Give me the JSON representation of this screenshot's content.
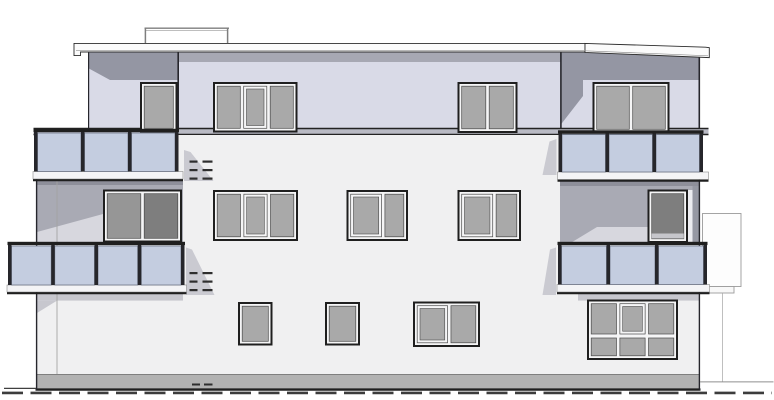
{
  "canvas": {
    "width": 774,
    "height": 400
  },
  "palette": {
    "background": "#ffffff",
    "line_dark": "#1f1f1f",
    "penthouse_wall": "#d9dae7",
    "penthouse_shadow_dark": "#9496a3",
    "penthouse_shadow_band": "#a7a8b3",
    "fascia_white": "#fbfbfb",
    "fascia_edge": "#2c2c2c",
    "terrace_band": "#b9bac4",
    "main_wall": "#f0f0f1",
    "recess_shadow": "#a9aab4",
    "recess_top_shadow": "#8e8f9a",
    "recess_light": "#d7d7de",
    "recess_white_strip": "#ececf0",
    "recess_corner": "#9698a3",
    "window_frame_white": "#f5f5f6",
    "window_glass": "#a9a9a9",
    "door_glass_dark": "#7e7e7e",
    "door_glass_mid": "#969696",
    "door_sill_light": "#c6c6cb",
    "balcony_glass": "#c4cde0",
    "balcony_frame": "#26262b",
    "slab_white": "#f4f4f6",
    "plinth_gray": "#b2b2b2",
    "soft_shadow": "#c7c7ce",
    "side_wedge": "#cacad1",
    "faint_line": "#9b9b9b",
    "rail_gray": "#808080",
    "vent_dark": "#2e2e2e",
    "ground_dash": "#3c3c3c"
  },
  "elements": {
    "windows": [
      {
        "id": "window-top-left-single",
        "x": 140,
        "y": 82,
        "w": 37.5,
        "h": 50.5,
        "panes": 1,
        "casement": null
      },
      {
        "id": "window-top-left-triple",
        "x": 213,
        "y": 82,
        "w": 84.5,
        "h": 50.5,
        "panes": 3,
        "casement": 1
      },
      {
        "id": "window-top-mid-double",
        "x": 457.5,
        "y": 82,
        "w": 60,
        "h": 51,
        "panes": 2,
        "casement": null
      },
      {
        "id": "window-top-right-double",
        "x": 592.5,
        "y": 82,
        "w": 77,
        "h": 51.5,
        "panes": 2,
        "casement": null
      },
      {
        "id": "door-mid-left-balcony",
        "x": 103,
        "y": 189.5,
        "w": 79,
        "h": 53,
        "panes": 2,
        "glass": "dark",
        "casement": null
      },
      {
        "id": "window-mid-triple",
        "x": 213,
        "y": 190,
        "w": 85,
        "h": 51,
        "panes": 3,
        "casement": 1
      },
      {
        "id": "window-mid-double-a",
        "x": 346.5,
        "y": 190,
        "w": 61.5,
        "h": 51,
        "panes": 2,
        "casement": 0,
        "split": [
          0.62,
          0.38
        ]
      },
      {
        "id": "window-mid-double-b",
        "x": 457.5,
        "y": 190,
        "w": 63.5,
        "h": 51,
        "panes": 2,
        "casement": 0,
        "split": [
          0.6,
          0.4
        ]
      },
      {
        "id": "door-mid-right-balcony",
        "x": 647.5,
        "y": 189.5,
        "w": 40.5,
        "h": 53.5,
        "panes": 1,
        "glass": "dark",
        "casement": null,
        "sill": true
      },
      {
        "id": "window-ground-small-1",
        "x": 238,
        "y": 302,
        "w": 34.5,
        "h": 43.5,
        "panes": 1,
        "casement": null
      },
      {
        "id": "window-ground-small-2",
        "x": 325,
        "y": 302,
        "w": 35,
        "h": 43.5,
        "panes": 1,
        "casement": null
      },
      {
        "id": "window-ground-double",
        "x": 413,
        "y": 301.5,
        "w": 67,
        "h": 45.5,
        "panes": 2,
        "casement": 0,
        "split": [
          0.55,
          0.45
        ]
      },
      {
        "id": "window-ground-large",
        "x": 587,
        "y": 299.5,
        "w": 91,
        "h": 60.5,
        "panes": 3,
        "rows": 2,
        "casement": 1
      }
    ],
    "balconies": [
      {
        "id": "balcony-upper-left",
        "x": 34,
        "w": 144.5,
        "rail_y": 128.8,
        "slab_x": 33,
        "slab_y": 171.5,
        "slab_w": 150,
        "slab_h": 7.5,
        "panels": 3
      },
      {
        "id": "balcony-upper-right",
        "x": 558.5,
        "w": 144.5,
        "rail_y": 130.3,
        "slab_x": 557.5,
        "slab_y": 172,
        "slab_w": 151,
        "slab_h": 7.5,
        "panels": 3
      },
      {
        "id": "balcony-lower-left",
        "x": 8,
        "w": 176.5,
        "rail_y": 241.8,
        "slab_x": 7,
        "slab_y": 285,
        "slab_w": 179.5,
        "slab_h": 7,
        "panels": 4
      },
      {
        "id": "balcony-lower-right",
        "x": 558,
        "w": 149,
        "rail_y": 241.8,
        "slab_x": 557,
        "slab_y": 284.5,
        "slab_w": 152.5,
        "slab_h": 7.5,
        "panels": 3
      }
    ],
    "vent_groups": [
      {
        "h": 2.2,
        "rows": [
          160.5,
          169,
          177.5
        ],
        "dashes": [
          [
            189.5,
            8
          ],
          [
            202.5,
            10
          ]
        ]
      },
      {
        "h": 2.2,
        "rows": [
          272,
          280.5,
          289
        ],
        "dashes": [
          [
            189.5,
            8
          ],
          [
            202.5,
            10
          ]
        ]
      },
      {
        "h": 2,
        "rows": [
          383.5
        ],
        "dashes": [
          [
            192,
            8
          ],
          [
            204,
            8.5
          ]
        ]
      }
    ]
  }
}
